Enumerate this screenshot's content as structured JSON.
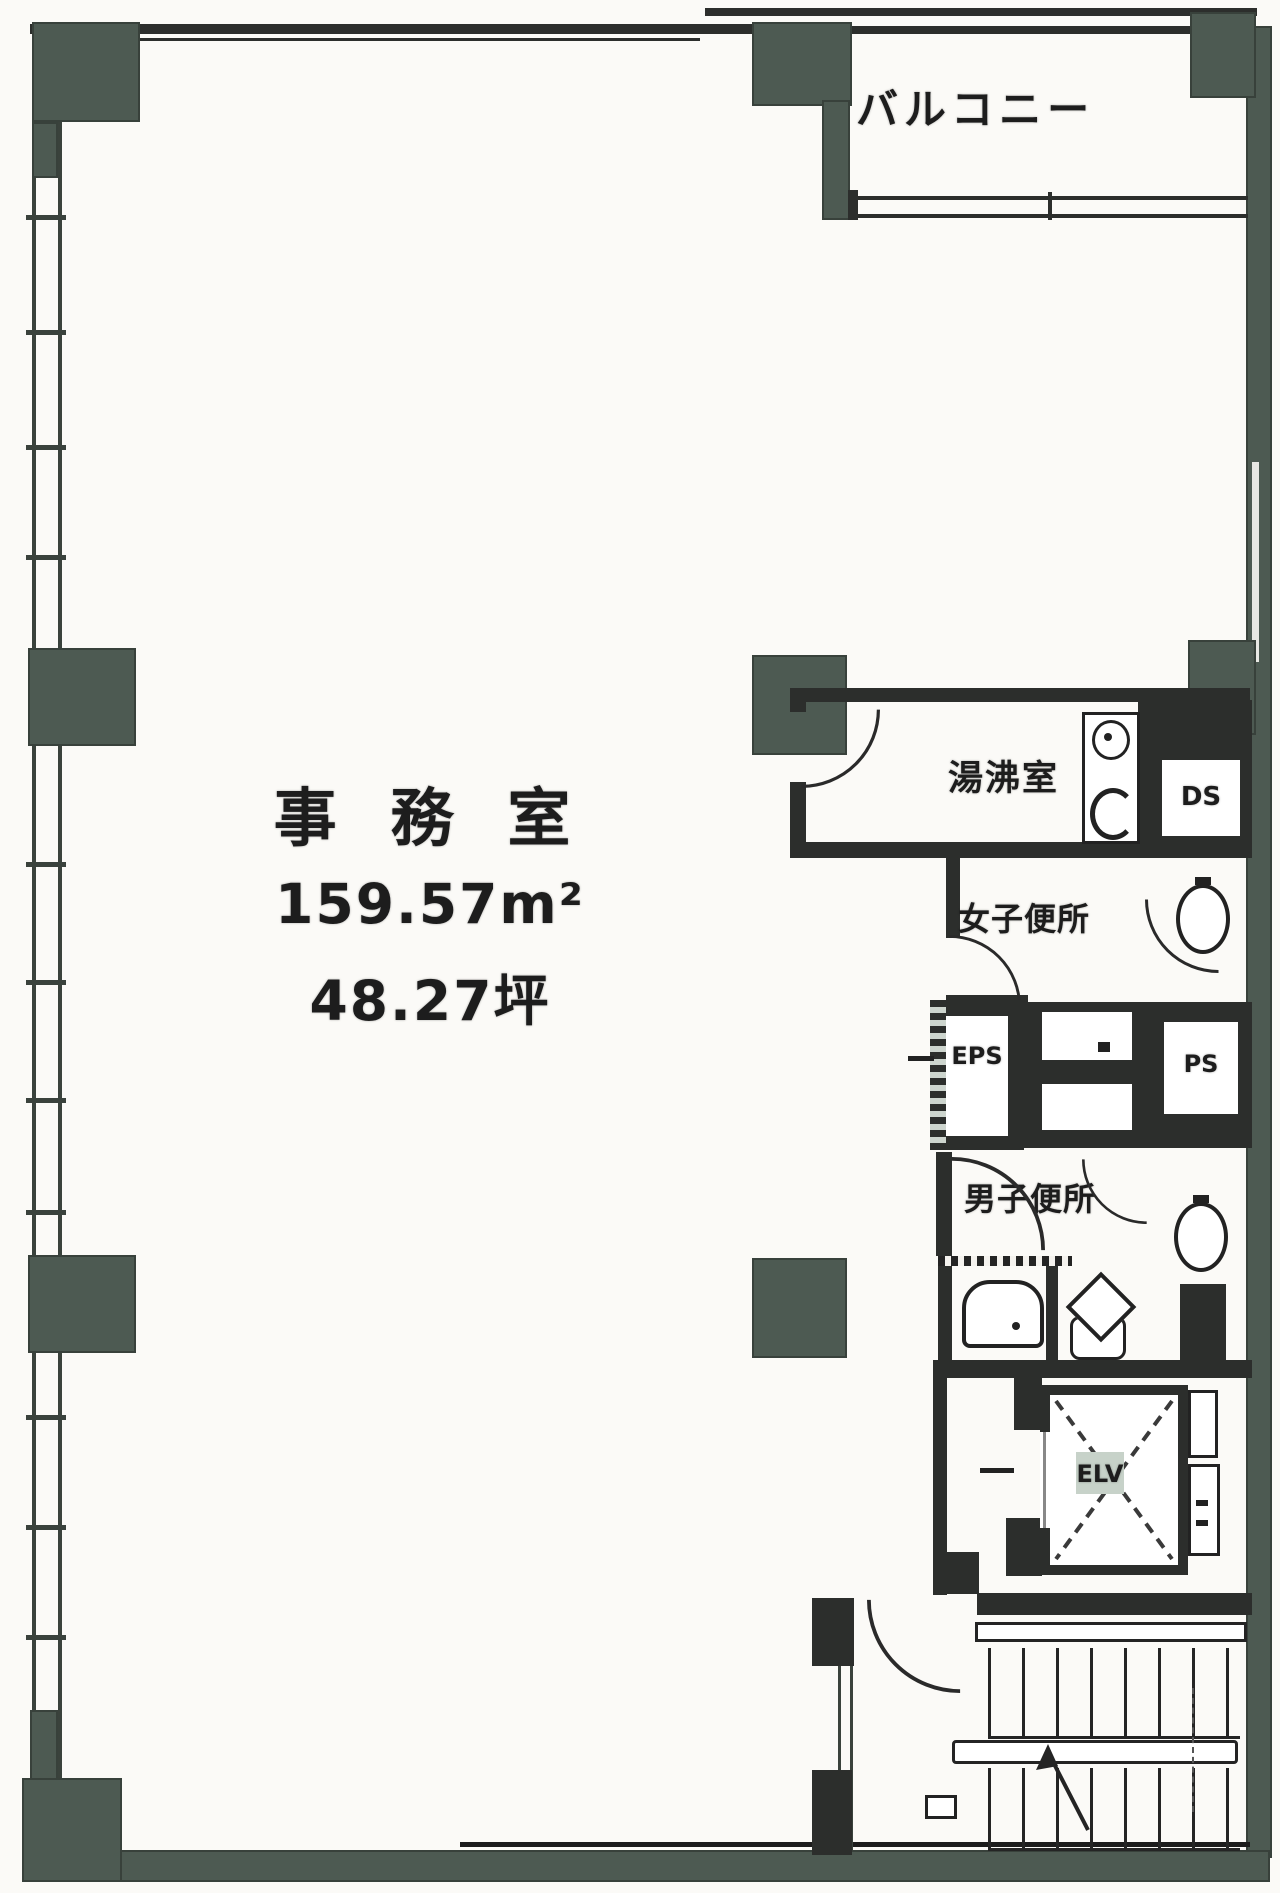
{
  "plan": {
    "main_room": {
      "name": "事 務 室",
      "area_m2": "159.57m²",
      "area_tsubo": "48.27坪"
    },
    "rooms": {
      "balcony": "バルコニー",
      "kitchenette": "湯沸室",
      "duct_space": "DS",
      "womens_toilet": "女子便所",
      "eps_shaft": "EPS",
      "pipe_space": "PS",
      "mens_toilet": "男子便所",
      "elevator": "ELV"
    },
    "colors": {
      "wall": "#2c2e2c",
      "pillar": "#4d5a52",
      "background": "#fbfaf7",
      "ink": "#1d1d1d",
      "elevator_badge": "#c7d2c9"
    }
  }
}
